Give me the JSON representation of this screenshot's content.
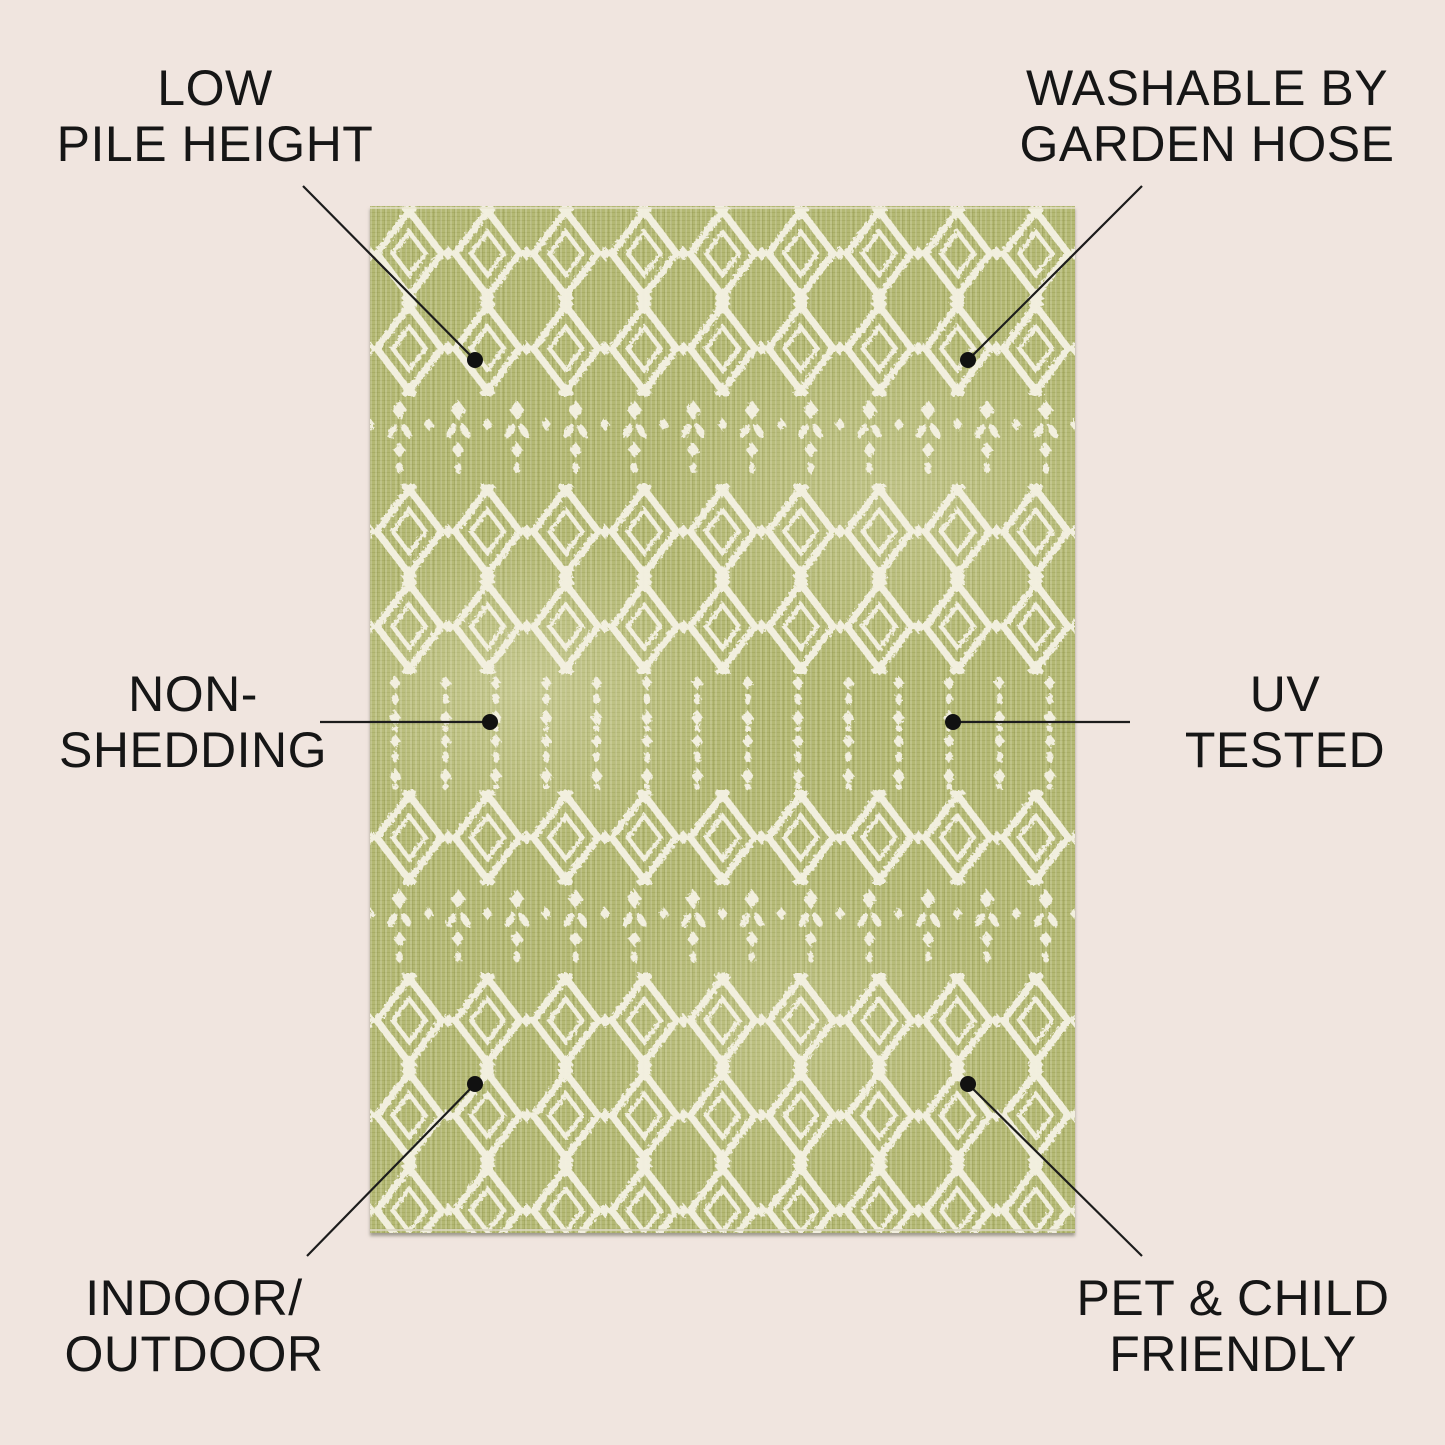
{
  "image_kind": "annotated-product-feature-image",
  "colors": {
    "background": "#f0e5df",
    "text": "#161616",
    "line": "#1c1c1c",
    "dot": "#111111",
    "rug_base": "#b3b873",
    "rug_motif": "#f4f1e2"
  },
  "rug": {
    "style": "moroccan-diamond-trellis",
    "ground_color": "#b3b873",
    "pattern_color": "#f4f1e2"
  },
  "callouts": [
    {
      "id": "low-pile-height",
      "position": "top-left",
      "lines": [
        "LOW",
        "PILE HEIGHT"
      ]
    },
    {
      "id": "washable-by-garden-hose",
      "position": "top-right",
      "lines": [
        "WASHABLE BY",
        "GARDEN HOSE"
      ]
    },
    {
      "id": "non-shedding",
      "position": "middle-left",
      "lines": [
        "NON-",
        "SHEDDING"
      ]
    },
    {
      "id": "uv-tested",
      "position": "middle-right",
      "lines": [
        "UV",
        "TESTED"
      ]
    },
    {
      "id": "indoor-outdoor",
      "position": "bottom-left",
      "lines": [
        "INDOOR/",
        "OUTDOOR"
      ]
    },
    {
      "id": "pet-child-friendly",
      "position": "bottom-right",
      "lines": [
        "PET & CHILD",
        "FRIENDLY"
      ]
    }
  ]
}
